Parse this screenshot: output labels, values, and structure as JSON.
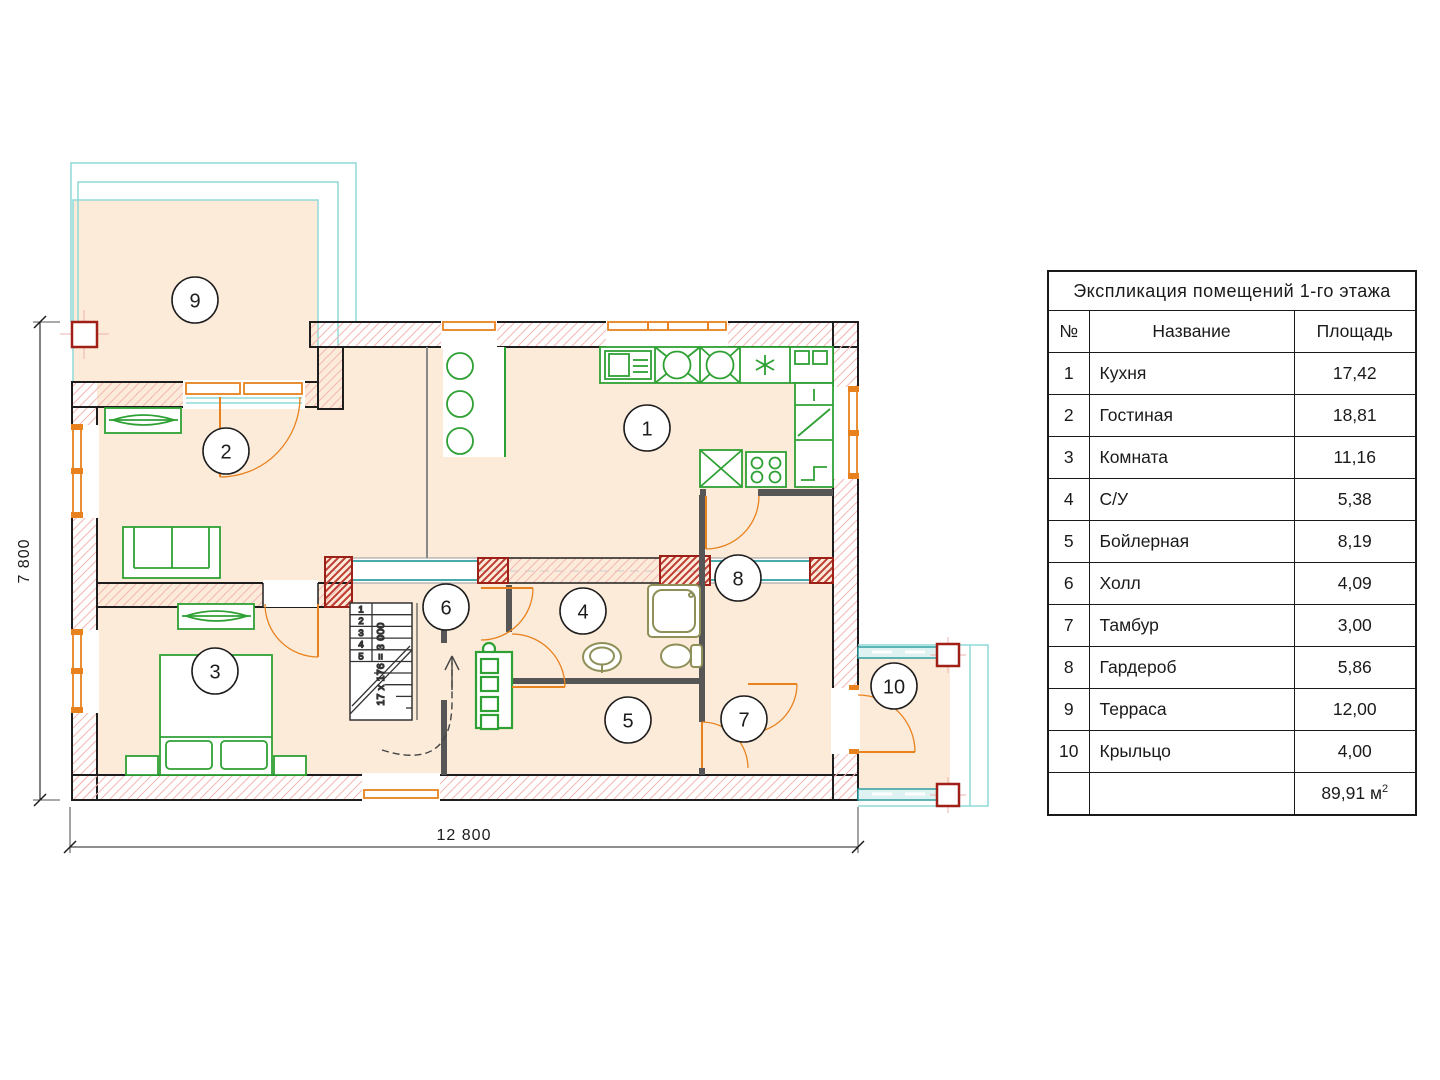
{
  "table": {
    "title": "Экспликация помещений 1-го этажа",
    "headers": {
      "num": "№",
      "name": "Название",
      "area": "Площадь"
    },
    "rows": [
      {
        "num": "1",
        "name": "Кухня",
        "area": "17,42"
      },
      {
        "num": "2",
        "name": "Гостиная",
        "area": "18,81"
      },
      {
        "num": "3",
        "name": "Комната",
        "area": "11,16"
      },
      {
        "num": "4",
        "name": "С/У",
        "area": "5,38"
      },
      {
        "num": "5",
        "name": "Бойлерная",
        "area": "8,19"
      },
      {
        "num": "6",
        "name": "Холл",
        "area": "4,09"
      },
      {
        "num": "7",
        "name": "Тамбур",
        "area": "3,00"
      },
      {
        "num": "8",
        "name": "Гардероб",
        "area": "5,86"
      },
      {
        "num": "9",
        "name": "Терраса",
        "area": "12,00"
      },
      {
        "num": "10",
        "name": "Крыльцо",
        "area": "4,00"
      }
    ],
    "total_value": "89,91",
    "total_unit": "м",
    "total_sup": "2"
  },
  "plan": {
    "labels": [
      "1",
      "2",
      "3",
      "4",
      "5",
      "6",
      "7",
      "8",
      "9",
      "10"
    ],
    "stair_steps": [
      "1",
      "2",
      "3",
      "4",
      "5"
    ],
    "stair_note": "17 x 176 = 3 000",
    "dim_width": "12 800",
    "dim_height": "7 800"
  },
  "colors": {
    "wall_hatch": "#f3b6b6",
    "brick_pier": "#bf3a30",
    "floor_fill": "#fcebd9",
    "furniture_green": "#2fa134",
    "door_orange": "#e8821f",
    "deck_cyan": "#8fd9d9",
    "rail_teal": "#2f9ea0",
    "sanitary_olive": "#8f8f58",
    "post_red": "#a02018"
  }
}
